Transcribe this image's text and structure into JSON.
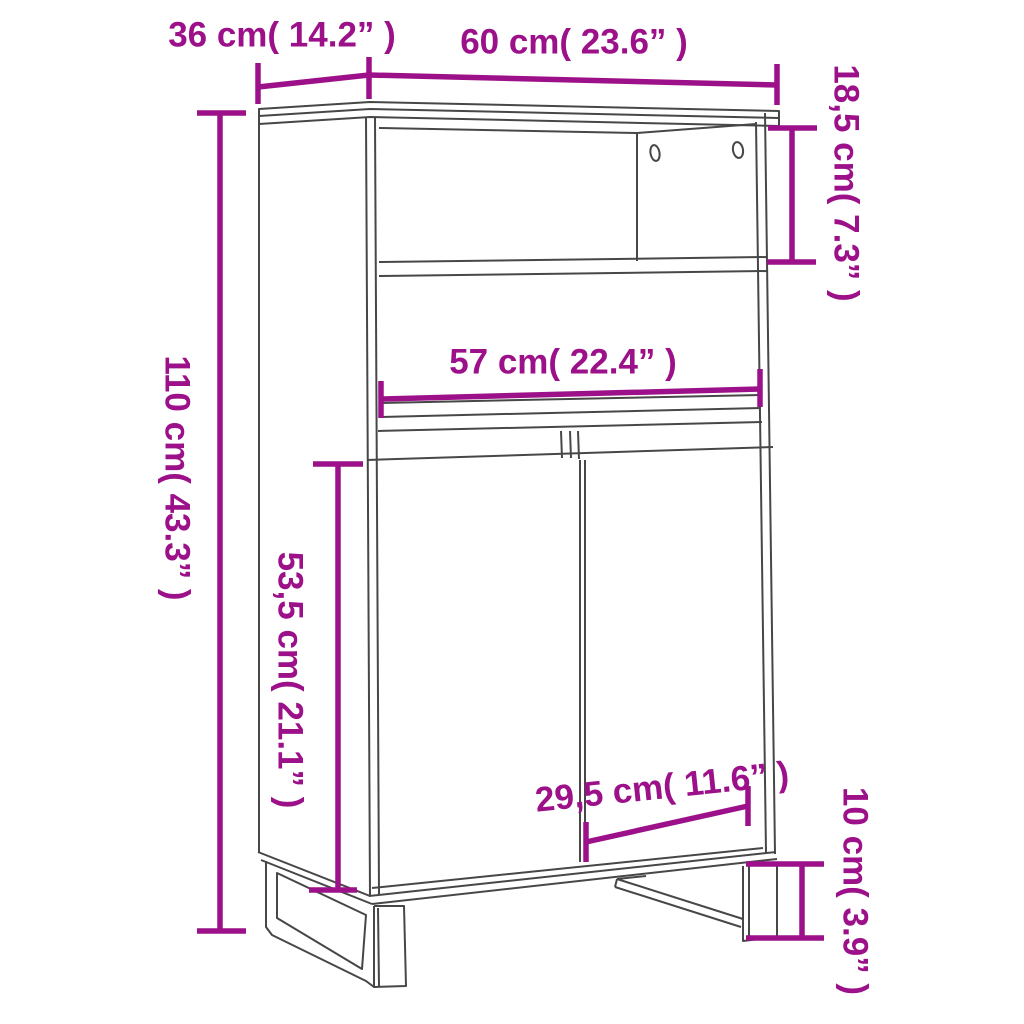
{
  "diagram": {
    "subject": "highboard cabinet dimension drawing",
    "style": "technical line drawing with dimension annotations"
  },
  "colors": {
    "accent": "#9C1189",
    "line": "#474747",
    "background": "#FFFFFF"
  },
  "dimensions": {
    "depth": {
      "label": "36 cm( 14.2” )"
    },
    "width": {
      "label": "60 cm( 23.6” )"
    },
    "shelf_height": {
      "label": "18,5 cm( 7.3” )"
    },
    "total_height": {
      "label": "110 cm( 43.3” )"
    },
    "inner_width": {
      "label": "57 cm( 22.4” )"
    },
    "door_height": {
      "label": "53,5 cm( 21.1” )"
    },
    "door_width": {
      "label": "29,5 cm( 11.6” )"
    },
    "leg_height": {
      "label": "10 cm( 3.9” )"
    }
  }
}
